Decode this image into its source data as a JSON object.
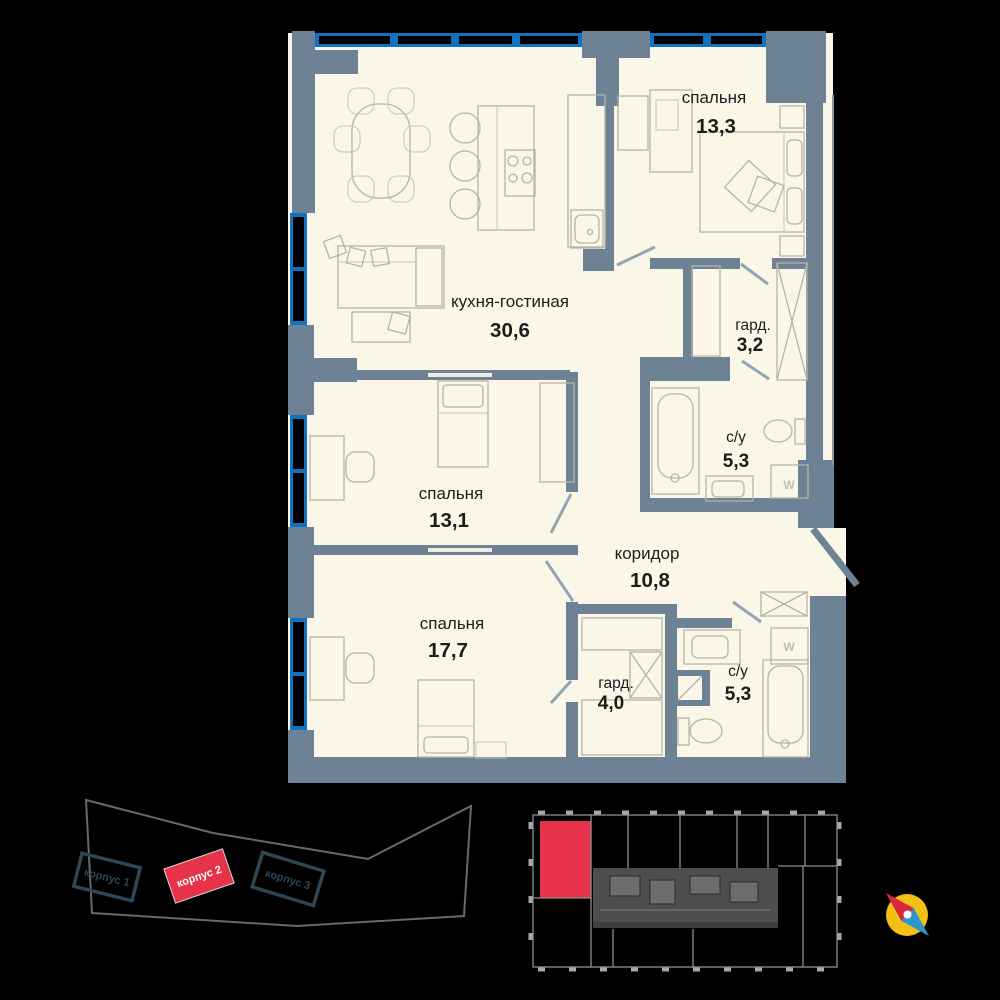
{
  "colors": {
    "background": "#000000",
    "floor": "#faf7e8",
    "wall": "#6d8294",
    "window_blue": "#1272c2",
    "accent_red": "#e73349",
    "building_stroke": "#2e4656",
    "compass_yellow": "#f2c114",
    "compass_red": "#d6293c",
    "compass_blue": "#2c95cc"
  },
  "floor_plan": {
    "rooms": [
      {
        "name": "спальня",
        "area": "13,3"
      },
      {
        "name": "кухня-гостиная",
        "area": "30,6"
      },
      {
        "name": "гард.",
        "area": "3,2"
      },
      {
        "name": "с/у",
        "area": "5,3"
      },
      {
        "name": "спальня",
        "area": "13,1"
      },
      {
        "name": "коридор",
        "area": "10,8"
      },
      {
        "name": "спальня",
        "area": "17,7"
      },
      {
        "name": "гард.",
        "area": "4,0"
      },
      {
        "name": "с/у",
        "area": "5,3"
      }
    ],
    "washer_label": "W"
  },
  "site_plan": {
    "buildings": [
      {
        "label": "корпус 1",
        "highlighted": false
      },
      {
        "label": "корпус 2",
        "highlighted": true
      },
      {
        "label": "корпус 3",
        "highlighted": false
      }
    ]
  }
}
